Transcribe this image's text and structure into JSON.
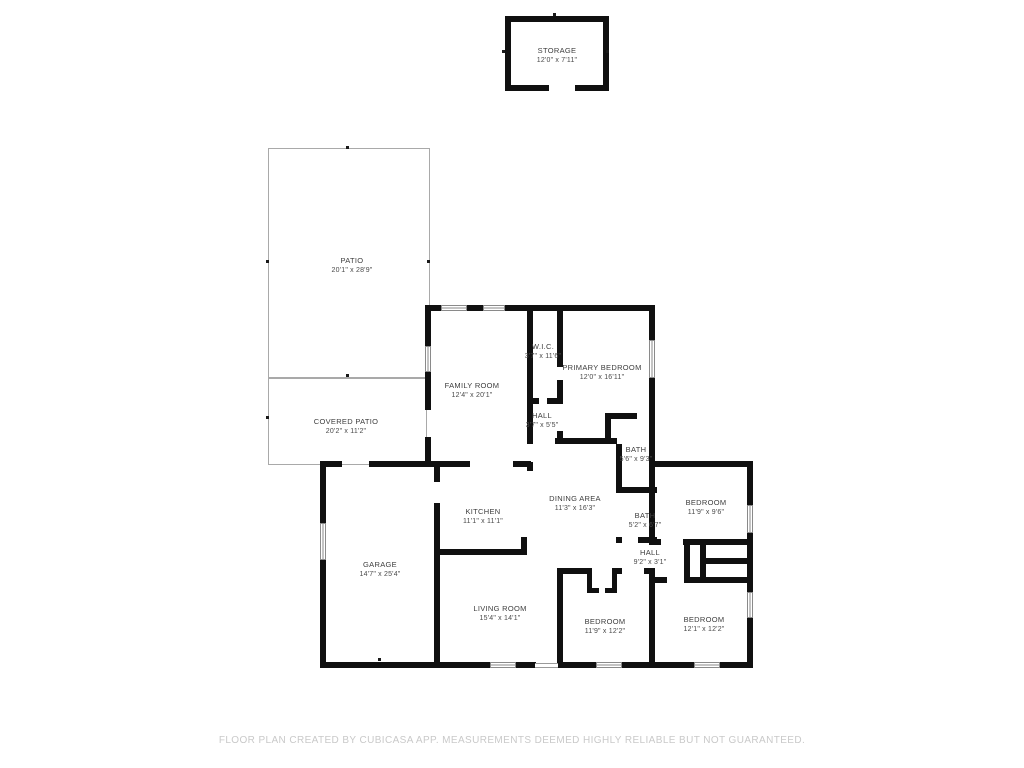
{
  "plan": {
    "source": "CubiCasa floor plan",
    "rooms": [
      {
        "id": "storage",
        "name": "STORAGE",
        "dims": "12'0\" x 7'11\""
      },
      {
        "id": "patio",
        "name": "PATIO",
        "dims": "20'1\" x 28'9\""
      },
      {
        "id": "covered-patio",
        "name": "COVERED PATIO",
        "dims": "20'2\" x 11'2\""
      },
      {
        "id": "family-room",
        "name": "FAMILY ROOM",
        "dims": "12'4\" x 20'1\""
      },
      {
        "id": "wic",
        "name": "W.I.C.",
        "dims": "3'7\" x 11'6\""
      },
      {
        "id": "primary-bedroom",
        "name": "PRIMARY BEDROOM",
        "dims": "12'0\" x 16'11\""
      },
      {
        "id": "hall-upper",
        "name": "HALL",
        "dims": "3'7\" x 5'5\""
      },
      {
        "id": "bath-primary",
        "name": "BATH",
        "dims": "5'6\" x 9'3\""
      },
      {
        "id": "kitchen",
        "name": "KITCHEN",
        "dims": "11'1\" x 11'1\""
      },
      {
        "id": "dining-area",
        "name": "DINING AREA",
        "dims": "11'3\" x 16'3\""
      },
      {
        "id": "bedroom-northeast",
        "name": "BEDROOM",
        "dims": "11'9\" x 9'6\""
      },
      {
        "id": "bath-hall",
        "name": "BATH",
        "dims": "5'2\" x 6'7\""
      },
      {
        "id": "hall-lower",
        "name": "HALL",
        "dims": "9'2\" x 3'1\""
      },
      {
        "id": "garage",
        "name": "GARAGE",
        "dims": "14'7\" x 25'4\""
      },
      {
        "id": "living-room",
        "name": "LIVING ROOM",
        "dims": "15'4\" x 14'1\""
      },
      {
        "id": "bedroom-south-left",
        "name": "BEDROOM",
        "dims": "11'9\" x 12'2\""
      },
      {
        "id": "bedroom-south-right",
        "name": "BEDROOM",
        "dims": "12'1\" x 12'2\""
      }
    ]
  },
  "footer": {
    "disclaimer": "FLOOR PLAN CREATED BY CUBICASA APP. MEASUREMENTS DEEMED HIGHLY RELIABLE BUT NOT GUARANTEED."
  },
  "colors": {
    "wall": "#101010",
    "thin_outline": "#a9a9a9",
    "label_text": "#3d3d3d",
    "footer_text": "#c9c9c9",
    "background": "#ffffff"
  }
}
